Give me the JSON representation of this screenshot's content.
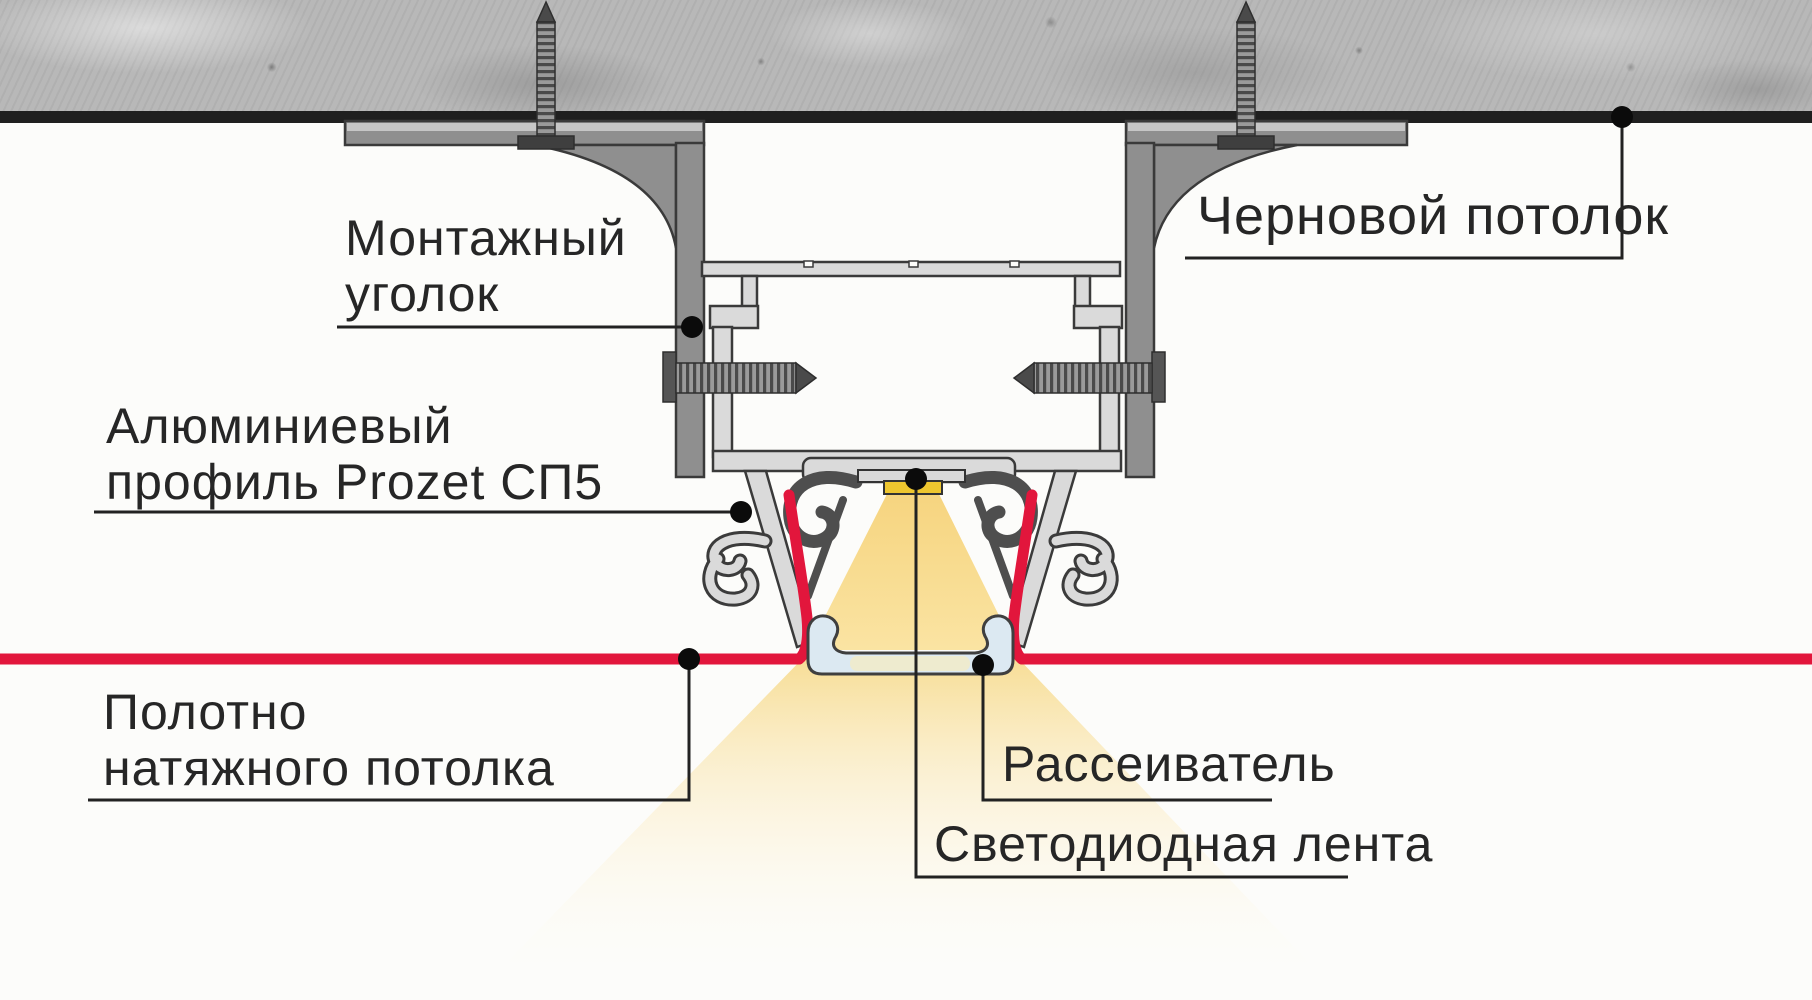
{
  "diagram": {
    "kind": "ceiling-led-profile-cross-section",
    "labels": {
      "mounting_bracket": {
        "line1": "Монтажный",
        "line2": "уголок"
      },
      "aluminum_profile": {
        "line1": "Алюминиевый",
        "line2": "профиль Prozet СП5"
      },
      "rough_ceiling": "Черновой потолок",
      "stretch_ceiling": {
        "line1": "Полотно",
        "line2": "натяжного потолка"
      },
      "diffuser": "Рассеиватель",
      "led_strip": "Светодиодная лента"
    },
    "colors": {
      "stretch_ceiling_red": "#e2163c",
      "led_yellow": "#eec62f",
      "light_beam_yellow": "#f7db8e",
      "diffuser_blue": "#dce9f2",
      "concrete_gray": "#b8b8b8",
      "aluminum_gray": "#dadada",
      "bracket_gray": "#8f8f8f",
      "callout_black": "#1a1a1a"
    }
  }
}
